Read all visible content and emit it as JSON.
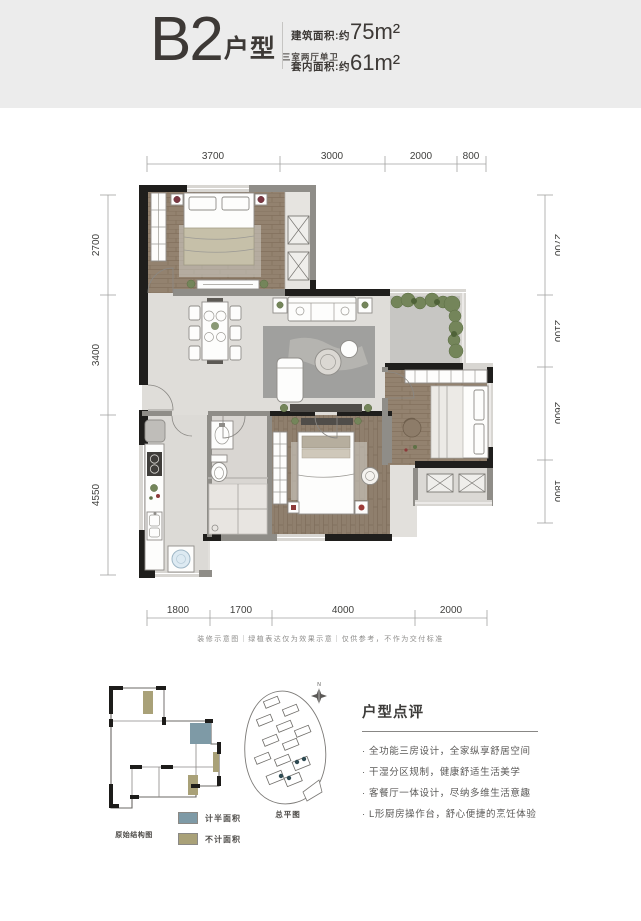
{
  "header": {
    "title": "B2",
    "title_suffix": "户型",
    "subtitle": "三室两厅单卫",
    "area1_label": "建筑面积:约",
    "area1_value": "75m²",
    "area2_label": "套内面积:约",
    "area2_value": "61m²"
  },
  "plan": {
    "dims_top": [
      "3700",
      "3000",
      "2000",
      "800"
    ],
    "dims_bottom": [
      "1800",
      "1700",
      "4000",
      "2000"
    ],
    "dims_left": [
      "2700",
      "3400",
      "4550"
    ],
    "dims_right": [
      "2700",
      "2100",
      "2600",
      "1800"
    ]
  },
  "disclaimer": "装修示意图｜绿植表达仅为效果示意｜仅供参考，不作为交付标准",
  "mini_plan": {
    "label": "原始结构图"
  },
  "site_plan": {
    "label": "总平图",
    "compass": "N"
  },
  "legend": [
    {
      "label": "计半面积",
      "color": "#7e9aa6"
    },
    {
      "label": "不计面积",
      "color": "#a9a178"
    }
  ],
  "review": {
    "heading": "户型点评",
    "bullets": [
      "· 全功能三房设计，全家纵享舒居空间",
      "· 干湿分区规制，健康舒适生活美学",
      "· 客餐厅一体设计，尽纳多维生活意趣",
      "· L形厨房操作台，舒心便捷的烹饪体验"
    ]
  }
}
